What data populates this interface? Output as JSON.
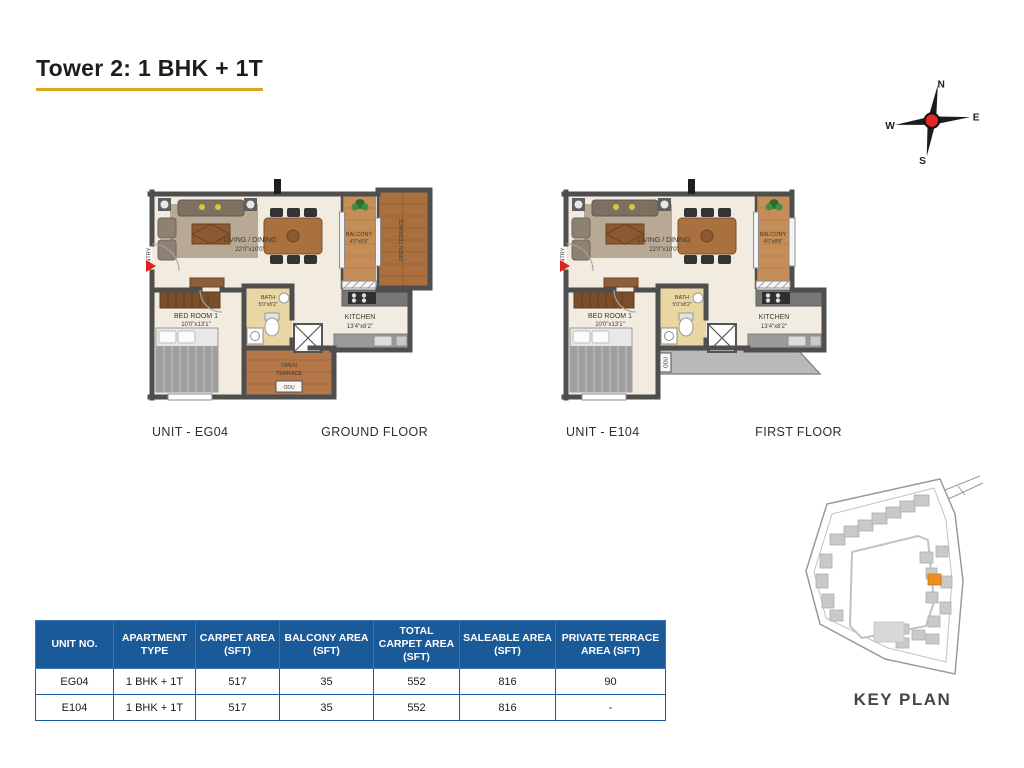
{
  "title": "Tower 2: 1 BHK + 1T",
  "compass": {
    "north": "N",
    "south": "S",
    "east": "E",
    "west": "W"
  },
  "plans": [
    {
      "unit": "UNIT - EG04",
      "floor": "GROUND FLOOR",
      "entry": "ENTRY",
      "living_name": "LIVING / DINING",
      "living_dim": "22'0\"x10'0\"",
      "balcony_name": "BALCONY",
      "balcony_dim": "4'0\"x8'8\"",
      "terrace_side": "OPEN TERRACE",
      "bed_name": "BED ROOM 1",
      "bed_dim": "10'0\"x13'1\"",
      "bath_name": "BATH",
      "bath_dim": "5'0\"x8'2\"",
      "kitchen_name": "KITCHEN",
      "kitchen_dim": "13'4\"x8'2\"",
      "terrace_l1": "OPEN",
      "terrace_l2": "TERRACE",
      "odu": "ODU"
    },
    {
      "unit": "UNIT - E104",
      "floor": "FIRST FLOOR",
      "entry": "ENTRY",
      "living_name": "LIVING / DINING",
      "living_dim": "22'0\"x10'0\"",
      "balcony_name": "BALCONY",
      "balcony_dim": "4'0\"x8'8\"",
      "bed_name": "BED ROOM 1",
      "bed_dim": "10'0\"x13'1\"",
      "bath_name": "BATH",
      "bath_dim": "5'0\"x8'2\"",
      "kitchen_name": "KITCHEN",
      "kitchen_dim": "13'4\"x8'2\"",
      "odu": "ODU"
    }
  ],
  "key_plan": {
    "label": "KEY PLAN"
  },
  "table": {
    "headers": [
      "UNIT NO.",
      "APARTMENT TYPE",
      "CARPET AREA (SFT)",
      "BALCONY AREA (SFT)",
      "TOTAL CARPET AREA (SFT)",
      "SALEABLE AREA (SFT)",
      "PRIVATE TERRACE AREA (SFT)"
    ],
    "rows": [
      [
        "EG04",
        "1 BHK + 1T",
        "517",
        "35",
        "552",
        "816",
        "90"
      ],
      [
        "E104",
        "1 BHK + 1T",
        "517",
        "35",
        "552",
        "816",
        "-"
      ]
    ]
  },
  "colors": {
    "accent_underline": "#d9a81e",
    "table_header_blue": "#1a5a99",
    "keyplan_highlight": "#ee8f26",
    "compass_center": "#e22626",
    "entry_arrow": "#e01f1f"
  }
}
